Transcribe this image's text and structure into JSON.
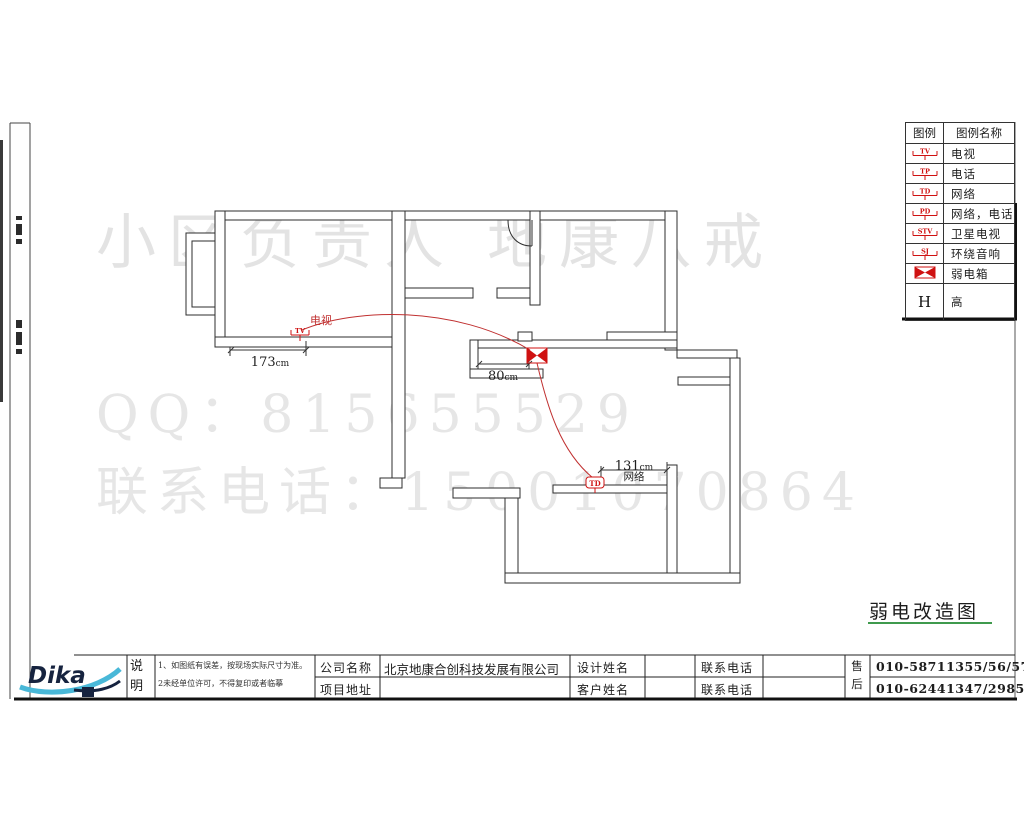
{
  "watermarks": {
    "line1": "小区负责人  地康八戒",
    "line2": "QQ：815655529",
    "line3": "联系电话：15001070864"
  },
  "legend": {
    "headers": [
      "图例",
      "图例名称"
    ],
    "rows": [
      {
        "symbol": "TV",
        "name": "电视"
      },
      {
        "symbol": "TP",
        "name": "电话"
      },
      {
        "symbol": "TD",
        "name": "网络"
      },
      {
        "symbol": "PD",
        "name": "网络，电话"
      },
      {
        "symbol": "STV",
        "name": "卫星电视"
      },
      {
        "symbol": "SJ",
        "name": "环绕音响"
      },
      {
        "symbol": "BOWTIE",
        "name": "弱电箱"
      },
      {
        "symbol": "H",
        "name": "高"
      }
    ]
  },
  "plan": {
    "tv_label": "电视",
    "network_label": "网络",
    "tv_symbol": "TV",
    "td_symbol": "TD",
    "dim1_value": "173",
    "dim1_unit": "cm",
    "dim2_value": "80",
    "dim2_unit": "cm",
    "dim3_value": "131",
    "dim3_unit": "cm"
  },
  "drawing_title": "弱电改造图",
  "title_block": {
    "note_label": "说明",
    "notes": [
      "1、如图纸有误差，按现场实际尺寸为准。",
      "2未经单位许可，不得复印或者临摹"
    ],
    "company_label": "公司名称",
    "company_value": "北京地康合创科技发展有限公司",
    "address_label": "项目地址",
    "address_value": "",
    "designer_label": "设计姓名",
    "designer_value": "",
    "customer_label": "客户姓名",
    "customer_value": "",
    "phone_label_1": "联系电话",
    "phone_value_1": "",
    "phone_label_2": "联系电话",
    "phone_value_2": "",
    "service_label": "售后",
    "service_phone_1": "010-58711355/56/57",
    "service_phone_2": "010-62441347/2985"
  },
  "logo_text": "Dika",
  "colors": {
    "symbol_red": "#cf1111",
    "wire_red": "#c03030",
    "watermark_gray": "#e3e3e3",
    "underline_green": "#3f9a4d"
  }
}
